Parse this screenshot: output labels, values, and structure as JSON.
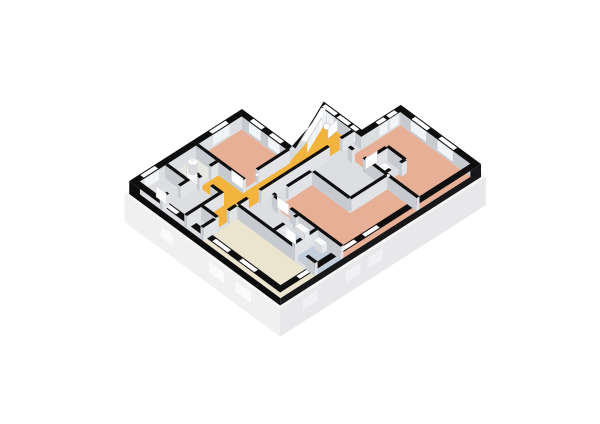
{
  "meta": {
    "type": "3d-floorplan-render",
    "background": "#ffffff"
  },
  "plan": {
    "projection": {
      "origin": [
        242,
        122
      ],
      "east": [
        19.1,
        14.1
      ],
      "south": [
        -20.5,
        13.1
      ],
      "wall_height_px": 13,
      "plinth_depth_px": 28
    },
    "palette": {
      "wallBlack": "#0e0e0f",
      "outerFaceS": "#0c0c0d",
      "outerFaceE": "#18181a",
      "innerFaceS": "#c7cbd0",
      "innerFaceE": "#dcdfe2",
      "diagFace": "#d6dadd",
      "floorBase": "#dcdee1",
      "salmon": "#e7af96",
      "amber": "#f2b43c",
      "cream": "#ebe4cf",
      "blue": "#c4cfdc",
      "wcFloor": "#e7e8e1",
      "wFaceS": "#c7cbd0",
      "wFaceE": "#e1e3e6",
      "plinthLip": "#f6f6f7",
      "plinthS": "#f0f0f1",
      "plinthE": "#e8e8ea",
      "plinthDiag": "#f2f3f5",
      "sillS": "#fafafa",
      "sillE": "#f1f1f3",
      "windowSlot": "#ffffff",
      "glassPanel": "#eef1f4",
      "mullion": "#ffffff",
      "fixture": "#fafafa",
      "fixtureShadeS": "#d9dadd",
      "fixtureShadeE": "#e9eaec",
      "leaf": "#fdfdfd",
      "leafEdge": "#c9c9c9",
      "handle": "#ffffff"
    },
    "envelope": {
      "outer": [
        [
          0,
          0
        ],
        [
          2.8,
          0
        ],
        [
          1.7,
          -2.4
        ],
        [
          3.7,
          -2.4
        ],
        [
          3.7,
          -4.3
        ],
        [
          7.9,
          -4.3
        ],
        [
          7.9,
          5.5
        ],
        [
          0,
          5.5
        ]
      ],
      "inner": [
        [
          0.27,
          0.27
        ],
        [
          2.7,
          0.27
        ],
        [
          2.02,
          -2.13
        ],
        [
          3.96,
          -2.13
        ],
        [
          3.96,
          -4.03
        ],
        [
          7.63,
          -4.03
        ],
        [
          7.63,
          5.23
        ],
        [
          0.27,
          5.23
        ]
      ],
      "plinth": [
        [
          -0.12,
          -0.12
        ],
        [
          2.74,
          -0.1
        ],
        [
          1.62,
          -2.5
        ],
        [
          3.58,
          -2.52
        ],
        [
          3.58,
          -4.42
        ],
        [
          8.02,
          -4.42
        ],
        [
          8.02,
          5.62
        ],
        [
          -0.12,
          5.62
        ]
      ]
    },
    "inner_faces": [
      {
        "a": [
          0.27,
          0.27
        ],
        "b": [
          2.7,
          0.27
        ],
        "c": "innerFaceS"
      },
      {
        "a": [
          2.7,
          0.27
        ],
        "b": [
          2.02,
          -2.13
        ],
        "c": "diagFace"
      },
      {
        "a": [
          2.02,
          -2.13
        ],
        "b": [
          3.96,
          -2.13
        ],
        "c": "innerFaceS"
      },
      {
        "a": [
          3.96,
          -2.13
        ],
        "b": [
          3.96,
          -4.03
        ],
        "c": "innerFaceE"
      },
      {
        "a": [
          3.96,
          -4.03
        ],
        "b": [
          7.63,
          -4.03
        ],
        "c": "innerFaceS"
      },
      {
        "a": [
          0.27,
          5.23
        ],
        "b": [
          0.27,
          0.27
        ],
        "c": "innerFaceE"
      }
    ],
    "floors": [
      {
        "name": "floor-base",
        "color": "floorBase",
        "poly": [
          [
            0.27,
            0.27
          ],
          [
            2.7,
            0.27
          ],
          [
            2.02,
            -2.13
          ],
          [
            3.96,
            -2.13
          ],
          [
            3.96,
            -4.03
          ],
          [
            7.63,
            -4.03
          ],
          [
            7.63,
            5.23
          ],
          [
            0.27,
            5.23
          ]
        ]
      },
      {
        "name": "floor-bedroom-left",
        "color": "salmon",
        "rect": [
          0.27,
          0.27,
          2.59,
          2.36
        ]
      },
      {
        "name": "floor-bedroom-right",
        "color": "salmon",
        "rect": [
          3.96,
          -4.03,
          7.63,
          -1.55
        ]
      },
      {
        "name": "floor-closet",
        "color": "floorBase",
        "rect": [
          5.02,
          -2.42,
          5.81,
          -1.62
        ]
      },
      {
        "name": "floor-bedroom-middle",
        "color": "salmon",
        "rect": [
          4.1,
          0.4,
          7.63,
          2.16
        ]
      },
      {
        "name": "floor-bedroom-middle-ext",
        "color": "salmon",
        "rect": [
          6.09,
          -1.41,
          7.63,
          0.4
        ]
      },
      {
        "name": "floor-hallway",
        "color": "amber",
        "poly": [
          [
            1.98,
            -2.13
          ],
          [
            3.44,
            -2.13
          ],
          [
            3.44,
            4.4
          ],
          [
            2.73,
            4.4
          ],
          [
            2.73,
            3.42
          ],
          [
            1.45,
            3.42
          ],
          [
            1.45,
            2.5
          ],
          [
            2.73,
            2.5
          ],
          [
            2.73,
            0.27
          ],
          [
            2.62,
            0.27
          ]
        ]
      },
      {
        "name": "floor-living-room",
        "color": "cream",
        "rect": [
          3.58,
          3.56,
          7.63,
          5.23
        ]
      },
      {
        "name": "floor-bathroom",
        "color": "blue",
        "rect": [
          5.44,
          2.3,
          6.3,
          3.42
        ]
      },
      {
        "name": "floor-shower-room",
        "color": "blue",
        "rect": [
          6.44,
          2.3,
          7.63,
          3.42
        ]
      },
      {
        "name": "floor-wc",
        "color": "wcFloor",
        "rect": [
          0.27,
          2.5,
          1.31,
          3.86
        ]
      }
    ],
    "walls": [
      {
        "seg": [
          2.66,
          0.2,
          2.66,
          2.5
        ],
        "gaps": [
          [
            1.75,
            2.36
          ]
        ],
        "name": "bedroom-left-east-wall"
      },
      {
        "seg": [
          0.27,
          2.43,
          2.73,
          2.43
        ],
        "gaps": [],
        "name": "bedroom-left-south-wall"
      },
      {
        "seg": [
          1.38,
          2.5,
          1.38,
          5.23
        ],
        "gaps": [
          [
            2.85,
            3.4
          ],
          [
            4.35,
            4.9
          ]
        ],
        "name": "wc-east-wall"
      },
      {
        "seg": [
          0.27,
          3.93,
          1.38,
          3.93
        ],
        "gaps": [],
        "name": "wc-south-wall"
      },
      {
        "seg": [
          1.45,
          3.49,
          2.73,
          3.49
        ],
        "gaps": [
          [
            1.6,
            2.15
          ]
        ],
        "name": "hall-south-wall"
      },
      {
        "seg": [
          2.66,
          3.56,
          2.66,
          5.23
        ],
        "gaps": [],
        "name": "storage-east-wall"
      },
      {
        "seg": [
          2.73,
          4.47,
          3.51,
          4.47
        ],
        "gaps": [],
        "name": "hallway-end-wall"
      },
      {
        "seg": [
          3.51,
          3.56,
          3.51,
          5.23
        ],
        "gaps": [
          [
            3.95,
            4.6
          ]
        ],
        "name": "living-west-wall"
      },
      {
        "seg": [
          3.58,
          3.49,
          7.63,
          3.49
        ],
        "gaps": [
          [
            6.6,
            7.15
          ]
        ],
        "name": "living-north-wall"
      },
      {
        "seg": [
          3.51,
          -2.13,
          3.51,
          3.49
        ],
        "gaps": [
          [
            -1.55,
            -0.95
          ],
          [
            2.4,
            3.0
          ]
        ],
        "name": "hallway-east-wall"
      },
      {
        "seg": [
          4.03,
          0.4,
          4.03,
          2.23
        ],
        "gaps": [
          [
            1.55,
            2.1
          ]
        ],
        "name": "bedroom-middle-west-wall"
      },
      {
        "seg": [
          4.1,
          0.33,
          6.02,
          0.33
        ],
        "gaps": [],
        "name": "bedroom-middle-north-wall"
      },
      {
        "seg": [
          4.03,
          -1.48,
          7.63,
          -1.48
        ],
        "gaps": [
          [
            4.25,
            4.8
          ]
        ],
        "name": "bedroom-right-south-wall"
      },
      {
        "seg": [
          4.95,
          -2.49,
          5.88,
          -2.49
        ],
        "gaps": [],
        "name": "closet-north-wall"
      },
      {
        "seg": [
          5.88,
          -2.49,
          5.88,
          -1.55
        ],
        "gaps": [
          [
            -2.25,
            -1.75
          ]
        ],
        "name": "closet-east-wall"
      },
      {
        "seg": [
          4.95,
          -2.42,
          4.95,
          -1.55
        ],
        "gaps": [],
        "name": "closet-west-wall"
      },
      {
        "seg": [
          6.02,
          -1.41,
          6.02,
          0.33
        ],
        "gaps": [],
        "name": "bedroom-middle-upper-west-wall"
      },
      {
        "seg": [
          4.1,
          2.23,
          7.63,
          2.23
        ],
        "gaps": [
          [
            4.35,
            4.95
          ]
        ],
        "name": "bathroom-north-wall"
      },
      {
        "seg": [
          5.37,
          2.3,
          5.37,
          3.42
        ],
        "gaps": [
          [
            2.45,
            2.95
          ]
        ],
        "name": "bathroom-west-wall"
      },
      {
        "seg": [
          6.37,
          2.3,
          6.37,
          3.42
        ],
        "gaps": [],
        "name": "bathroom-divider-wall"
      }
    ],
    "windows": [
      {
        "o": [
          [
            0,
            0.85
          ],
          [
            0,
            1.65
          ]
        ],
        "inw": [
          1,
          0
        ]
      },
      {
        "o": [
          [
            0,
            4.3
          ],
          [
            0,
            5.0
          ]
        ],
        "inw": [
          1,
          0
        ]
      },
      {
        "o": [
          [
            0.65,
            0
          ],
          [
            1.25,
            0
          ]
        ],
        "inw": [
          0,
          1
        ]
      },
      {
        "o": [
          [
            1.65,
            0
          ],
          [
            2.25,
            0
          ]
        ],
        "inw": [
          0,
          1
        ]
      },
      {
        "o": [
          [
            2.6,
            -0.43
          ],
          [
            1.83,
            -2.11
          ]
        ],
        "inw": [
          0.91,
          -0.42
        ],
        "glass": true,
        "mullions": 2
      },
      {
        "o": [
          [
            1.85,
            -2.4
          ],
          [
            2.5,
            -2.4
          ]
        ],
        "inw": [
          0,
          1
        ],
        "glass": true,
        "mullions": 1
      },
      {
        "o": [
          [
            3.3,
            -2.4
          ],
          [
            3.62,
            -2.4
          ]
        ],
        "inw": [
          0,
          1
        ],
        "glass": true,
        "mullions": 0
      },
      {
        "o": [
          [
            3.7,
            -3.02
          ],
          [
            3.7,
            -3.4
          ]
        ],
        "inw": [
          1,
          0
        ]
      },
      {
        "o": [
          [
            3.7,
            -3.54
          ],
          [
            3.7,
            -3.94
          ]
        ],
        "inw": [
          1,
          0
        ]
      },
      {
        "o": [
          [
            4.5,
            -4.3
          ],
          [
            5.3,
            -4.3
          ]
        ],
        "inw": [
          0,
          1
        ]
      },
      {
        "o": [
          [
            5.9,
            -4.3
          ],
          [
            6.7,
            -4.3
          ]
        ],
        "inw": [
          0,
          1
        ]
      },
      {
        "o": [
          [
            7.9,
            0.6
          ],
          [
            7.9,
            1.3
          ]
        ],
        "inw": [
          -1,
          0
        ]
      },
      {
        "o": [
          [
            7.9,
            1.7
          ],
          [
            7.9,
            2.4
          ]
        ],
        "inw": [
          -1,
          0
        ]
      },
      {
        "o": [
          [
            7.9,
            3.8
          ],
          [
            7.9,
            4.5
          ]
        ],
        "inw": [
          -1,
          0
        ]
      },
      {
        "o": [
          [
            1.8,
            5.5
          ],
          [
            2.4,
            5.5
          ]
        ],
        "inw": [
          0,
          -1
        ]
      },
      {
        "o": [
          [
            4.3,
            5.5
          ],
          [
            5.1,
            5.5
          ]
        ],
        "inw": [
          0,
          -1
        ]
      },
      {
        "o": [
          [
            5.7,
            5.5
          ],
          [
            6.5,
            5.5
          ]
        ],
        "inw": [
          0,
          -1
        ]
      }
    ],
    "door_slots": [
      {
        "o": [
          [
            2.62,
            -2.4
          ],
          [
            3.2,
            -2.4
          ]
        ],
        "inw": [
          0,
          1
        ]
      }
    ],
    "doors": [
      {
        "hinge": [
          2.64,
          -2.2
        ],
        "end": [
          2.72,
          -1.66
        ],
        "name": "front-door-leaf"
      },
      {
        "hinge": [
          2.59,
          2.36
        ],
        "end": [
          1.98,
          2.36
        ],
        "name": "bedroom-left-door-leaf"
      },
      {
        "hinge": [
          1.31,
          3.4
        ],
        "end": [
          0.76,
          3.4
        ],
        "name": "wc-door-leaf"
      },
      {
        "hinge": [
          1.31,
          4.9
        ],
        "end": [
          0.76,
          4.9
        ],
        "name": "storage-door-leaf"
      },
      {
        "hinge": [
          4.1,
          2.1
        ],
        "end": [
          4.71,
          2.1
        ],
        "name": "bedroom-middle-door-leaf"
      },
      {
        "hinge": [
          4.8,
          -1.55
        ],
        "end": [
          4.8,
          -2.13
        ],
        "name": "bedroom-right-door-leaf"
      },
      {
        "hinge": [
          5.44,
          2.95
        ],
        "end": [
          5.99,
          2.95
        ],
        "name": "bathroom-door-leaf"
      }
    ],
    "fixtures": [
      {
        "type": "cylinder",
        "name": "water-heater",
        "at": [
          0.7,
          3.05
        ],
        "r": 0.26,
        "h": 10
      },
      {
        "type": "box",
        "name": "toilet",
        "rect": [
          5.18,
          -2.05,
          5.62,
          -1.72
        ],
        "h": 7,
        "behind": true
      },
      {
        "type": "box",
        "name": "washbasin",
        "rect": [
          5.55,
          2.34,
          6.05,
          2.58
        ],
        "h": 8
      },
      {
        "type": "box",
        "name": "washbasin-2",
        "rect": [
          6.55,
          2.34,
          6.95,
          2.58
        ],
        "h": 8
      },
      {
        "type": "lamp",
        "name": "pendant-light",
        "at": [
          2.72,
          -1.6
        ]
      }
    ],
    "handles": [
      [
        1.36,
        3.52
      ],
      [
        5.4,
        3.0
      ],
      [
        5.86,
        -1.68
      ],
      [
        2.64,
        1.72
      ]
    ],
    "sills": {
      "south": [
        [
          1.8,
          2.4
        ],
        [
          4.3,
          5.1
        ],
        [
          5.7,
          6.5
        ]
      ],
      "east": [
        [
          0.6,
          1.3
        ],
        [
          1.7,
          2.4
        ],
        [
          3.8,
          4.5
        ]
      ]
    }
  }
}
